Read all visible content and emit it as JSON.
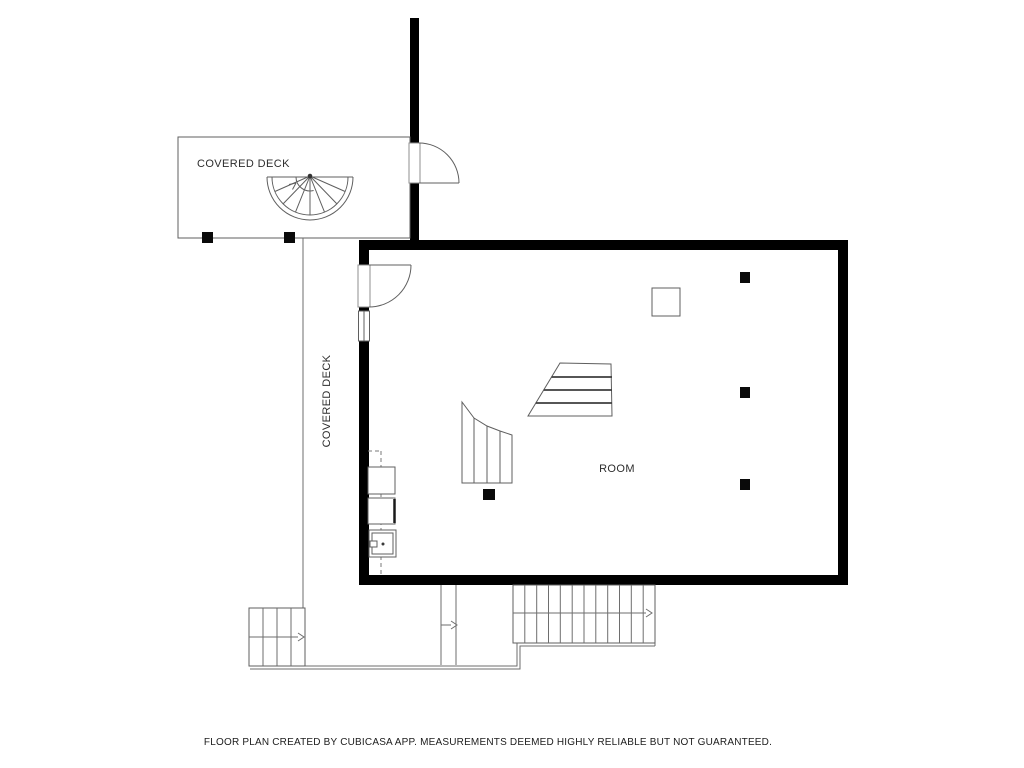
{
  "labels": {
    "deck_top": "COVERED DECK",
    "deck_side": "COVERED DECK",
    "room": "ROOM"
  },
  "footer": {
    "disclaimer": "FLOOR PLAN CREATED BY CUBICASA APP. MEASUREMENTS DEEMED HIGHLY RELIABLE BUT NOT GUARANTEED."
  },
  "colors": {
    "wall": "#000000",
    "line": "#5f5f5f",
    "text": "#2d2d2d",
    "background": "#ffffff"
  }
}
